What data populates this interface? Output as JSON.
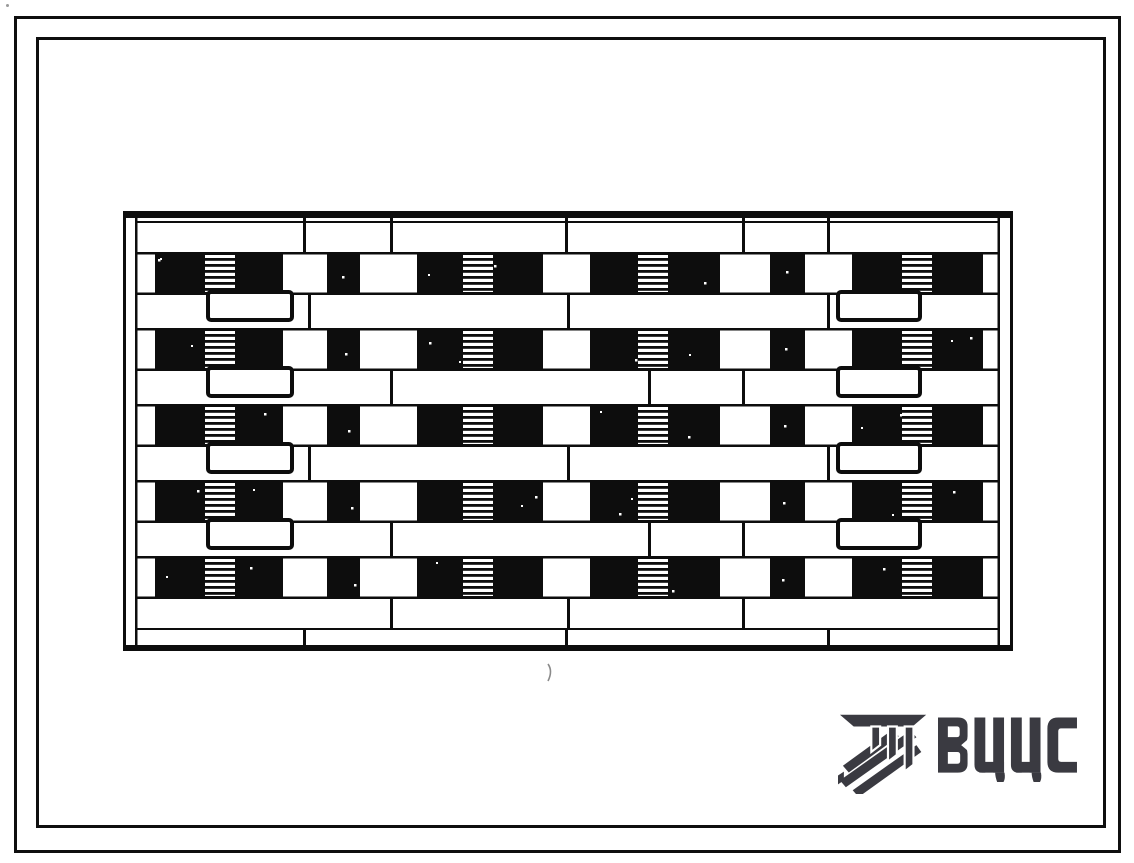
{
  "document": {
    "kind": "scanned standard-design album sheet",
    "drawing": "street facade elevation of a five-storey large-panel apartment building"
  },
  "colors": {
    "ink": "#0d0d0d",
    "paper": "#ffffff",
    "logo": "#3a3a41",
    "artifact": "#8a8a8a"
  },
  "logo": {
    "text": "ВЦЦС",
    "icon": "hatched-beam-emblem"
  },
  "facade": {
    "width": 890,
    "height": 440,
    "roof_band_h": 7,
    "roof_underline_y": 10,
    "inner_left": 14,
    "inner_right": 877,
    "parapet": {
      "y": 7,
      "h": 34,
      "joints": [
        180,
        267,
        442,
        619,
        704
      ]
    },
    "floors": {
      "count": 5,
      "first_top": 41,
      "pitch": 76,
      "dark_h": 43
    },
    "dark_segments": [
      [
        32,
        160
      ],
      [
        204,
        237
      ],
      [
        294,
        420
      ],
      [
        467,
        597
      ],
      [
        647,
        682
      ],
      [
        729,
        860
      ]
    ],
    "stripe_blocks": [
      [
        82,
        112
      ],
      [
        340,
        370
      ],
      [
        515,
        545
      ],
      [
        779,
        809
      ]
    ],
    "spandrel": {
      "h": 33,
      "joints_even": [
        185,
        444,
        704
      ],
      "joints_odd": [
        267,
        525,
        619
      ]
    },
    "balconies": {
      "floors_with_balconies": [
        0,
        1,
        2,
        3
      ],
      "left": {
        "x": 85,
        "w": 84
      },
      "right": {
        "x": 715,
        "w": 82
      },
      "h": 28
    },
    "base": {
      "band1": {
        "y": 388,
        "h": 29,
        "joints": [
          267,
          444,
          619
        ]
      },
      "line_y": 417,
      "band2": {
        "y": 419,
        "h": 17,
        "joints": [
          180,
          442,
          704
        ]
      },
      "ground_y": 434,
      "ground_h": 6
    }
  }
}
